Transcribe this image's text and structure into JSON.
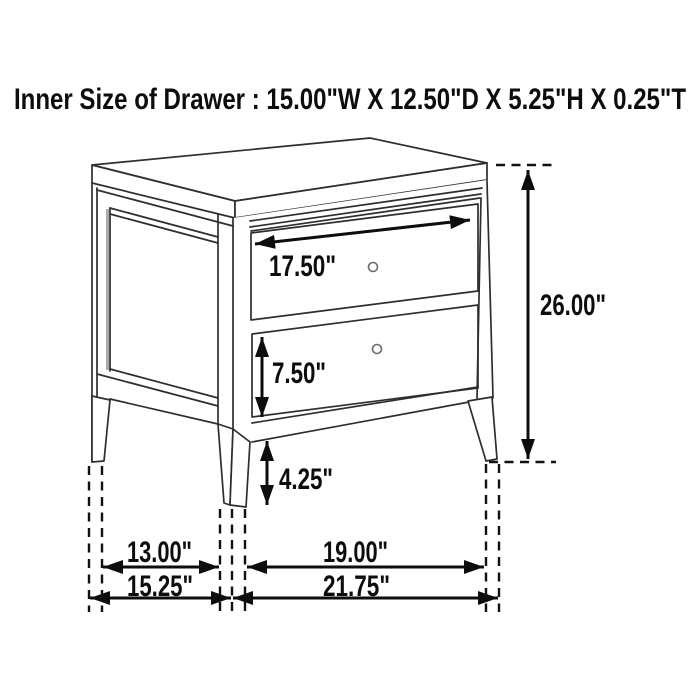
{
  "title": "Inner Size of Drawer : 15.00\"W X 12.50\"D X 5.25\"H X 0.25\"T",
  "colors": {
    "background": "#ffffff",
    "line_art": "#2e2e2e",
    "dimension_lines": "#0d0d0d",
    "text": "#0d0d0d",
    "knob_outline": "#6b6b6b"
  },
  "dimensions": {
    "top_drawer_width": "17.50\"",
    "overall_height": "26.00\"",
    "bottom_drawer_height": "7.50\"",
    "leg_height": "4.25\"",
    "inner_depth": "13.00\"",
    "inner_width": "19.00\"",
    "overall_depth": "15.25\"",
    "overall_width": "21.75\""
  }
}
